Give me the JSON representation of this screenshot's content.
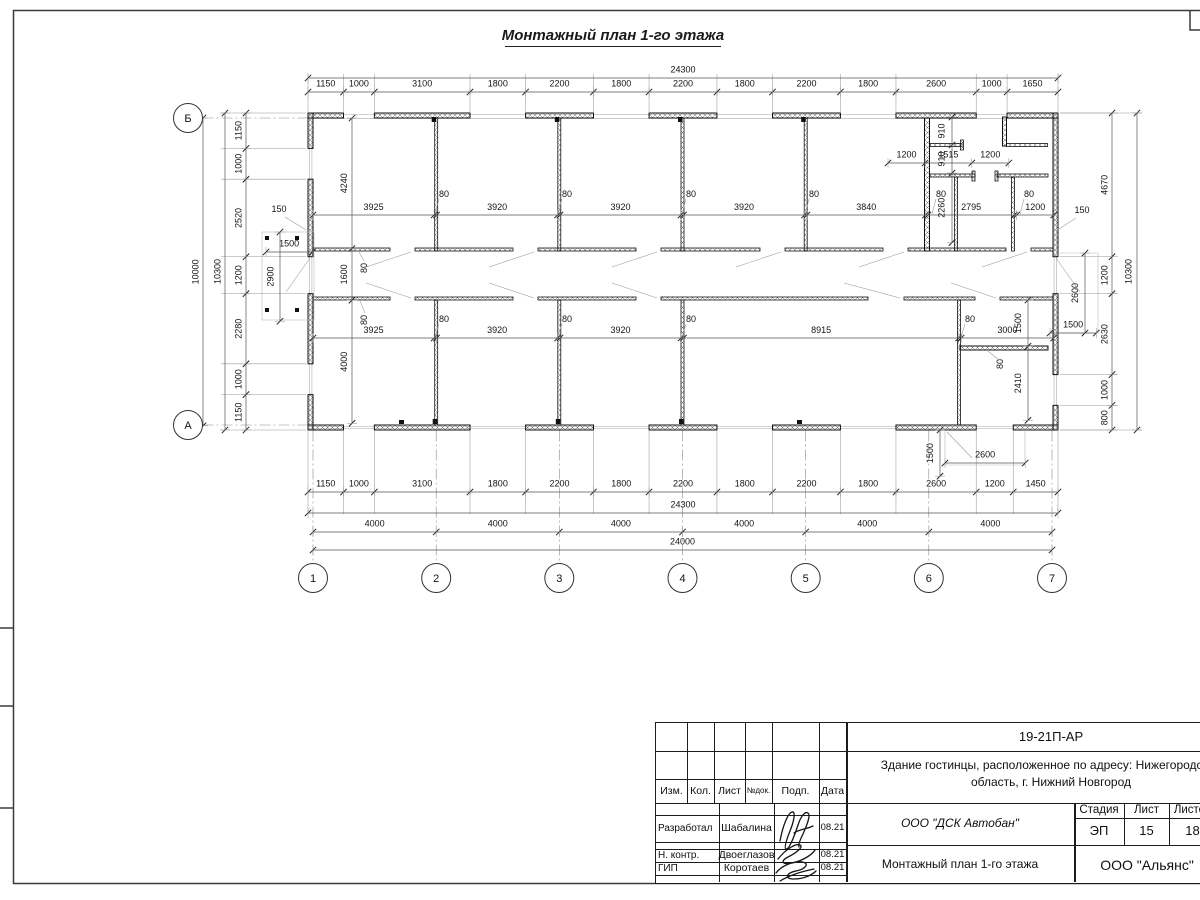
{
  "sheet": {
    "plan_title": "Монтажный план 1-го этажа"
  },
  "axes": {
    "cols": [
      "1",
      "2",
      "3",
      "4",
      "5",
      "6",
      "7"
    ],
    "rows": [
      "Б",
      "А"
    ]
  },
  "dims": {
    "top_segments": [
      "1150",
      "1000",
      "3100",
      "1800",
      "2200",
      "1800",
      "2200",
      "1800",
      "2200",
      "1800",
      "2600",
      "1000",
      "1650"
    ],
    "top_total": "24300",
    "bottom_segments": [
      "1150",
      "1000",
      "3100",
      "1800",
      "2200",
      "1800",
      "2200",
      "1800",
      "2200",
      "1800",
      "2600",
      "1200",
      "1450"
    ],
    "bottom_total": "24300",
    "bays": [
      "4000",
      "4000",
      "4000",
      "4000",
      "4000",
      "4000"
    ],
    "overall_width": "24000",
    "left_segments": [
      "1150",
      "1000",
      "2520",
      "1200",
      "2280",
      "1000",
      "1150"
    ],
    "left_total": "10300",
    "left_overall": "10000",
    "right_segments": [
      "4670",
      "1200",
      "2630",
      "1000",
      "800"
    ],
    "right_total": "10300",
    "rooms_top": [
      "3925",
      "3920",
      "3920",
      "3920",
      "3840",
      "2795",
      "1200"
    ],
    "rooms_bottom": [
      "3925",
      "3920",
      "3920",
      "8915",
      "3000"
    ],
    "depth_top": "4240",
    "corridor_width": "1600",
    "depth_bottom": "4000",
    "partition": "80",
    "wall": "150",
    "d910": "910",
    "d1200": "1200",
    "d1515": "1515",
    "d2260": "2260",
    "d1500": "1500",
    "d2410": "2410",
    "d2900": "2900",
    "d2600": "2600"
  },
  "stamp": {
    "doc_number": "19-21П-АР",
    "object_line1": "Здание гостинцы, расположенное по адресу: Нижегородская",
    "object_line2": "область, г. Нижний Новгород",
    "columns": [
      "Изм.",
      "Кол.",
      "Лист",
      "№док.",
      "Подп.",
      "Дата"
    ],
    "stage_label": "Стадия",
    "sheet_label": "Лист",
    "sheets_label": "Листов",
    "stage": "ЭП",
    "sheet_number": "15",
    "sheets_total": "18",
    "contractor": "ООО \"ДСК Автобан\"",
    "drawing_name": "Монтажный план 1-го этажа",
    "company": "ООО \"Альянс\"",
    "rows": [
      {
        "role": "Разработал",
        "name": "Шабалина",
        "date": "08.21"
      },
      {
        "role": "Н. контр.",
        "name": "Двоеглазов",
        "date": "08.21"
      },
      {
        "role": "ГИП",
        "name": "Коротаев",
        "date": "08.21"
      }
    ]
  }
}
